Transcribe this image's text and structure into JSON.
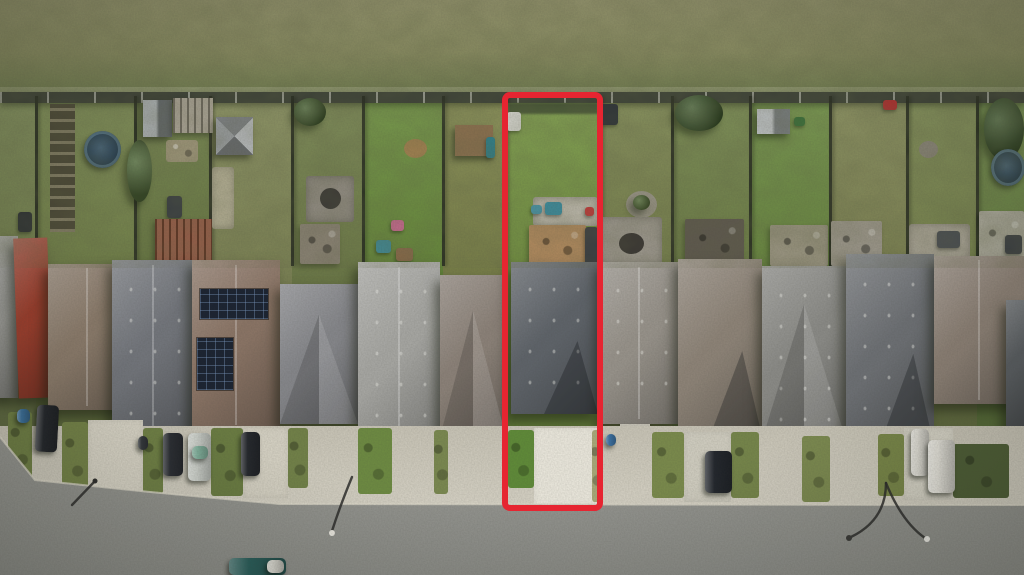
{
  "scene": {
    "description": "Aerial drone photograph of a row of suburban homes between a scrub field and a street; one narrow lot is outlined in red",
    "width": 1024,
    "height": 575
  },
  "palette": {
    "field_top": "#91916b",
    "field_mid": "#878a60",
    "field_bottom": "#6e7a4e",
    "back_fence": "#3d4237",
    "front_concrete": "#cdc9bb",
    "street_top": "#a8a7a1",
    "street_bottom": "#8f908b",
    "curb": "#dcd8ca",
    "highlight_red": "#e62531"
  },
  "field": {
    "y": 0,
    "h": 96
  },
  "back_fence": {
    "y": 92,
    "h": 11
  },
  "lots": [
    {
      "x": 0,
      "w": 36,
      "grass": "#7c8a55"
    },
    {
      "x": 36,
      "w": 99,
      "grass": "#79894f"
    },
    {
      "x": 135,
      "w": 75,
      "grass": "#6f8048"
    },
    {
      "x": 210,
      "w": 82,
      "grass": "#868d5c"
    },
    {
      "x": 292,
      "w": 71,
      "grass": "#75834e"
    },
    {
      "x": 363,
      "w": 80,
      "grass": "#6d9040"
    },
    {
      "x": 443,
      "w": 62,
      "grass": "#82894f"
    },
    {
      "x": 505,
      "w": 95,
      "grass": "#7a9a47"
    },
    {
      "x": 600,
      "w": 72,
      "grass": "#7e8852"
    },
    {
      "x": 672,
      "w": 78,
      "grass": "#74864c"
    },
    {
      "x": 750,
      "w": 80,
      "grass": "#6f8f45"
    },
    {
      "x": 830,
      "w": 77,
      "grass": "#848a58"
    },
    {
      "x": 907,
      "w": 70,
      "grass": "#7d8a52"
    },
    {
      "x": 977,
      "w": 47,
      "grass": "#6f8a48"
    }
  ],
  "yard_items": [
    {
      "type": "garden-rows",
      "x": 50,
      "y": 104,
      "w": 25,
      "h": 128,
      "color": "#55523e"
    },
    {
      "type": "bin",
      "x": 18,
      "y": 212,
      "w": 14,
      "h": 20,
      "color": "#2f3335"
    },
    {
      "type": "pool",
      "x": 84,
      "y": 131,
      "w": 37,
      "h": 37,
      "color": "#2e4e66"
    },
    {
      "type": "tree",
      "x": 127,
      "y": 140,
      "w": 25,
      "h": 62,
      "color": "#4d6a36"
    },
    {
      "type": "shed",
      "x": 143,
      "y": 100,
      "w": 29,
      "h": 37,
      "color": "#7d8488"
    },
    {
      "type": "pergola",
      "x": 173,
      "y": 98,
      "w": 40,
      "h": 35,
      "color": "#9e9788"
    },
    {
      "type": "clutter",
      "x": 166,
      "y": 140,
      "w": 32,
      "h": 22,
      "color": "#9c9478"
    },
    {
      "type": "object",
      "x": 167,
      "y": 196,
      "w": 15,
      "h": 22,
      "color": "#3a3f42"
    },
    {
      "type": "deck-red",
      "x": 155,
      "y": 219,
      "w": 57,
      "h": 46,
      "color": "#8a4b34"
    },
    {
      "type": "shed-pyramid",
      "x": 216,
      "y": 117,
      "w": 37,
      "h": 38,
      "color": "#8e9296"
    },
    {
      "type": "patch",
      "x": 212,
      "y": 167,
      "w": 22,
      "h": 62,
      "color": "#b5b096"
    },
    {
      "type": "tree",
      "x": 294,
      "y": 98,
      "w": 32,
      "h": 28,
      "color": "#44602f"
    },
    {
      "type": "gravel-patio",
      "x": 306,
      "y": 176,
      "w": 48,
      "h": 46,
      "color": "#8f8a80"
    },
    {
      "type": "firepit",
      "x": 320,
      "y": 188,
      "w": 21,
      "h": 21,
      "color": "#3c3a36"
    },
    {
      "type": "deck",
      "x": 300,
      "y": 224,
      "w": 40,
      "h": 40,
      "color": "#8a8274"
    },
    {
      "type": "firepit-ring",
      "x": 404,
      "y": 139,
      "w": 23,
      "h": 19,
      "color": "#a08050"
    },
    {
      "type": "toy",
      "x": 391,
      "y": 220,
      "w": 13,
      "h": 11,
      "color": "#c06a8a"
    },
    {
      "type": "toy",
      "x": 376,
      "y": 240,
      "w": 15,
      "h": 13,
      "color": "#3f8a96"
    },
    {
      "type": "toy",
      "x": 396,
      "y": 248,
      "w": 17,
      "h": 13,
      "color": "#8a6a4a"
    },
    {
      "type": "play-structure",
      "x": 455,
      "y": 125,
      "w": 38,
      "h": 31,
      "color": "#8a6f4e"
    },
    {
      "type": "toy",
      "x": 486,
      "y": 137,
      "w": 9,
      "h": 21,
      "color": "#2f7f8a"
    },
    {
      "type": "shadow-strip",
      "x": 508,
      "y": 103,
      "w": 90,
      "h": 11,
      "color": "#3f4a33"
    },
    {
      "type": "object",
      "x": 507,
      "y": 112,
      "w": 14,
      "h": 19,
      "color": "#d8d8d2"
    },
    {
      "type": "patio",
      "x": 533,
      "y": 197,
      "w": 65,
      "h": 29,
      "color": "#b9b5a8"
    },
    {
      "type": "toy",
      "x": 545,
      "y": 202,
      "w": 17,
      "h": 13,
      "color": "#3c8a9a"
    },
    {
      "type": "toy",
      "x": 531,
      "y": 205,
      "w": 11,
      "h": 9,
      "color": "#4a90a0"
    },
    {
      "type": "deck",
      "x": 529,
      "y": 225,
      "w": 57,
      "h": 41,
      "color": "#b0895e"
    },
    {
      "type": "object",
      "x": 585,
      "y": 227,
      "w": 13,
      "h": 40,
      "color": "#3a3e42"
    },
    {
      "type": "toy",
      "x": 585,
      "y": 207,
      "w": 9,
      "h": 9,
      "color": "#c03a3a"
    },
    {
      "type": "object",
      "x": 600,
      "y": 104,
      "w": 18,
      "h": 21,
      "color": "#2e3338"
    },
    {
      "type": "planter-ring",
      "x": 626,
      "y": 191,
      "w": 31,
      "h": 27,
      "color": "#9a9588"
    },
    {
      "type": "bush",
      "x": 633,
      "y": 195,
      "w": 17,
      "h": 15,
      "color": "#4e6a33"
    },
    {
      "type": "patio",
      "x": 600,
      "y": 217,
      "w": 62,
      "h": 49,
      "color": "#9b968c"
    },
    {
      "type": "firepit",
      "x": 619,
      "y": 233,
      "w": 25,
      "h": 21,
      "color": "#3a3733"
    },
    {
      "type": "tree",
      "x": 675,
      "y": 95,
      "w": 48,
      "h": 36,
      "color": "#3f5c2e"
    },
    {
      "type": "deck-dark",
      "x": 685,
      "y": 219,
      "w": 59,
      "h": 47,
      "color": "#5e584e"
    },
    {
      "type": "shed",
      "x": 757,
      "y": 109,
      "w": 33,
      "h": 25,
      "color": "#9aa0a4"
    },
    {
      "type": "toy",
      "x": 794,
      "y": 117,
      "w": 11,
      "h": 9,
      "color": "#3a6f3a"
    },
    {
      "type": "deck",
      "x": 770,
      "y": 225,
      "w": 58,
      "h": 41,
      "color": "#98937f"
    },
    {
      "type": "toy",
      "x": 883,
      "y": 100,
      "w": 14,
      "h": 10,
      "color": "#b03030"
    },
    {
      "type": "deck",
      "x": 831,
      "y": 221,
      "w": 51,
      "h": 45,
      "color": "#9b968a"
    },
    {
      "type": "firepit-ring",
      "x": 919,
      "y": 141,
      "w": 19,
      "h": 17,
      "color": "#8a8578"
    },
    {
      "type": "patio",
      "x": 909,
      "y": 224,
      "w": 61,
      "h": 43,
      "color": "#a9a496"
    },
    {
      "type": "object",
      "x": 937,
      "y": 231,
      "w": 23,
      "h": 17,
      "color": "#4a4e52"
    },
    {
      "type": "tree",
      "x": 984,
      "y": 98,
      "w": 40,
      "h": 62,
      "color": "#3e5a2c"
    },
    {
      "type": "pool",
      "x": 991,
      "y": 149,
      "w": 34,
      "h": 37,
      "color": "#35505e"
    },
    {
      "type": "deck",
      "x": 979,
      "y": 211,
      "w": 45,
      "h": 55,
      "color": "#aaa89a"
    },
    {
      "type": "object",
      "x": 1005,
      "y": 235,
      "w": 17,
      "h": 19,
      "color": "#3c4044"
    }
  ],
  "houses": [
    {
      "x": -14,
      "y": 236,
      "w": 32,
      "h": 162,
      "color": "#9a9a96",
      "variant": "plain"
    },
    {
      "x": 16,
      "y": 238,
      "w": 34,
      "h": 160,
      "color": "#9c3e2d",
      "variant": "plain",
      "rot": -2
    },
    {
      "x": 48,
      "y": 264,
      "w": 78,
      "h": 146,
      "color": "#8b7b6b",
      "variant": "hip"
    },
    {
      "x": 112,
      "y": 260,
      "w": 82,
      "h": 174,
      "color": "#72757b",
      "variant": "hip",
      "vents": true
    },
    {
      "x": 192,
      "y": 260,
      "w": 88,
      "h": 170,
      "color": "#8a7465",
      "variant": "hip"
    },
    {
      "x": 280,
      "y": 284,
      "w": 78,
      "h": 140,
      "color": "#85868a",
      "variant": "gable"
    },
    {
      "x": 358,
      "y": 262,
      "w": 82,
      "h": 180,
      "color": "#a6a6a2",
      "variant": "hip",
      "vents": true
    },
    {
      "x": 440,
      "y": 275,
      "w": 66,
      "h": 162,
      "color": "#8b8178",
      "variant": "gable"
    },
    {
      "x": 511,
      "y": 262,
      "w": 87,
      "h": 152,
      "color": "#5e6369",
      "variant": "gable-down",
      "vents": true
    },
    {
      "x": 600,
      "y": 262,
      "w": 78,
      "h": 162,
      "color": "#97928a",
      "variant": "hip",
      "vents": true
    },
    {
      "x": 678,
      "y": 259,
      "w": 84,
      "h": 177,
      "color": "#8d8377",
      "variant": "gable-down"
    },
    {
      "x": 762,
      "y": 266,
      "w": 84,
      "h": 174,
      "color": "#8a8a86",
      "variant": "gable",
      "vents": true
    },
    {
      "x": 846,
      "y": 254,
      "w": 88,
      "h": 192,
      "color": "#6c6f73",
      "variant": "gable-down",
      "vents": true
    },
    {
      "x": 934,
      "y": 256,
      "w": 90,
      "h": 148,
      "color": "#8c8075",
      "variant": "hip"
    },
    {
      "x": 1006,
      "y": 300,
      "w": 18,
      "h": 130,
      "color": "#5a5e62",
      "variant": "plain"
    }
  ],
  "house_items": [
    {
      "type": "solar",
      "x": 200,
      "y": 289,
      "w": 68,
      "h": 30
    },
    {
      "type": "solar",
      "x": 197,
      "y": 338,
      "w": 36,
      "h": 52
    },
    {
      "type": "porch",
      "x": 540,
      "y": 426,
      "w": 42,
      "h": 14,
      "color": "#c9c5ba"
    },
    {
      "type": "porch",
      "x": 620,
      "y": 424,
      "w": 30,
      "h": 12,
      "color": "#c4c0b4"
    }
  ],
  "driveways": [
    {
      "x": 88,
      "y": 420,
      "w": 55,
      "h": 74,
      "color": "#d8d4c6"
    },
    {
      "x": 243,
      "y": 428,
      "w": 45,
      "h": 70,
      "color": "#d4d0c2"
    },
    {
      "x": 534,
      "y": 428,
      "w": 64,
      "h": 80,
      "color": "#e9e6db"
    },
    {
      "x": 684,
      "y": 432,
      "w": 47,
      "h": 70,
      "color": "#cfccbf"
    },
    {
      "x": 904,
      "y": 428,
      "w": 49,
      "h": 72,
      "color": "#d6d3c6"
    }
  ],
  "grass_strips": [
    {
      "x": 8,
      "y": 412,
      "w": 24,
      "h": 68,
      "color": "#6f7f45"
    },
    {
      "x": 62,
      "y": 422,
      "w": 26,
      "h": 70,
      "color": "#748348"
    },
    {
      "x": 143,
      "y": 428,
      "w": 20,
      "h": 66,
      "color": "#6f8045"
    },
    {
      "x": 211,
      "y": 428,
      "w": 32,
      "h": 68,
      "color": "#6a7c42"
    },
    {
      "x": 288,
      "y": 428,
      "w": 20,
      "h": 60,
      "color": "#718148"
    },
    {
      "x": 358,
      "y": 428,
      "w": 34,
      "h": 66,
      "color": "#6d8a42"
    },
    {
      "x": 434,
      "y": 430,
      "w": 14,
      "h": 64,
      "color": "#7a8850"
    },
    {
      "x": 508,
      "y": 430,
      "w": 26,
      "h": 58,
      "color": "#5f8a38"
    },
    {
      "x": 592,
      "y": 430,
      "w": 10,
      "h": 72,
      "color": "#a8a878"
    },
    {
      "x": 652,
      "y": 432,
      "w": 32,
      "h": 66,
      "color": "#7a8a4c"
    },
    {
      "x": 731,
      "y": 432,
      "w": 28,
      "h": 66,
      "color": "#75854a"
    },
    {
      "x": 802,
      "y": 436,
      "w": 28,
      "h": 66,
      "color": "#7c8a50"
    },
    {
      "x": 878,
      "y": 434,
      "w": 26,
      "h": 62,
      "color": "#788648"
    },
    {
      "x": 953,
      "y": 444,
      "w": 56,
      "h": 54,
      "color": "#4e5e36"
    }
  ],
  "street": {
    "curb_points": "0,437 35,480 150,492 280,504 1024,505"
  },
  "vehicles": [
    {
      "type": "suv",
      "x": 36,
      "y": 405,
      "w": 22,
      "h": 47,
      "color": "#23262b",
      "rot": 3
    },
    {
      "type": "bin",
      "x": 17,
      "y": 409,
      "w": 13,
      "h": 14,
      "color": "#3a6f9a"
    },
    {
      "type": "bin",
      "x": 138,
      "y": 436,
      "w": 10,
      "h": 14,
      "color": "#33373b"
    },
    {
      "type": "car",
      "x": 163,
      "y": 433,
      "w": 20,
      "h": 43,
      "color": "#2a2d33"
    },
    {
      "type": "car",
      "x": 188,
      "y": 433,
      "w": 23,
      "h": 48,
      "color": "#ccd0ca"
    },
    {
      "type": "car-glass",
      "x": 192,
      "y": 446,
      "w": 16,
      "h": 13,
      "color": "#7fae9a"
    },
    {
      "type": "car",
      "x": 241,
      "y": 432,
      "w": 19,
      "h": 44,
      "color": "#24272c"
    },
    {
      "type": "bin",
      "x": 606,
      "y": 434,
      "w": 10,
      "h": 12,
      "color": "#3a6fa0"
    },
    {
      "type": "car",
      "x": 705,
      "y": 451,
      "w": 27,
      "h": 42,
      "color": "#22262c"
    },
    {
      "type": "trailer",
      "x": 911,
      "y": 429,
      "w": 18,
      "h": 47,
      "color": "#dedcd4"
    },
    {
      "type": "camper-van",
      "x": 928,
      "y": 440,
      "w": 27,
      "h": 53,
      "color": "#e6e4dc"
    }
  ],
  "street_vehicles": [
    {
      "type": "car",
      "x": 229,
      "y": 558,
      "w": 57,
      "h": 17,
      "color": "#2a5f5c"
    },
    {
      "type": "car-part",
      "x": 267,
      "y": 560,
      "w": 17,
      "h": 13,
      "color": "#d9d8d0"
    }
  ],
  "lamps": [
    {
      "d": "M352,477 Q340,506 332,531",
      "head": {
        "cx": 332,
        "cy": 533,
        "r": 3,
        "color": "#eceae2"
      }
    },
    {
      "d": "M95,481 L72,505",
      "head": {
        "cx": 95,
        "cy": 481,
        "r": 2.5,
        "color": "#2e2e2c"
      }
    },
    {
      "d": "M886,483 Q886,520 851,537",
      "head": {
        "cx": 849,
        "cy": 538,
        "r": 3,
        "color": "#3a3a38"
      }
    },
    {
      "d": "M886,483 Q902,522 925,538",
      "head": {
        "cx": 927,
        "cy": 539,
        "r": 3,
        "color": "#efeee8"
      }
    }
  ],
  "highlight_box": {
    "x": 505,
    "y": 95,
    "w": 95,
    "h": 413,
    "stroke": 6,
    "radius": 8,
    "color": "#e62531"
  }
}
